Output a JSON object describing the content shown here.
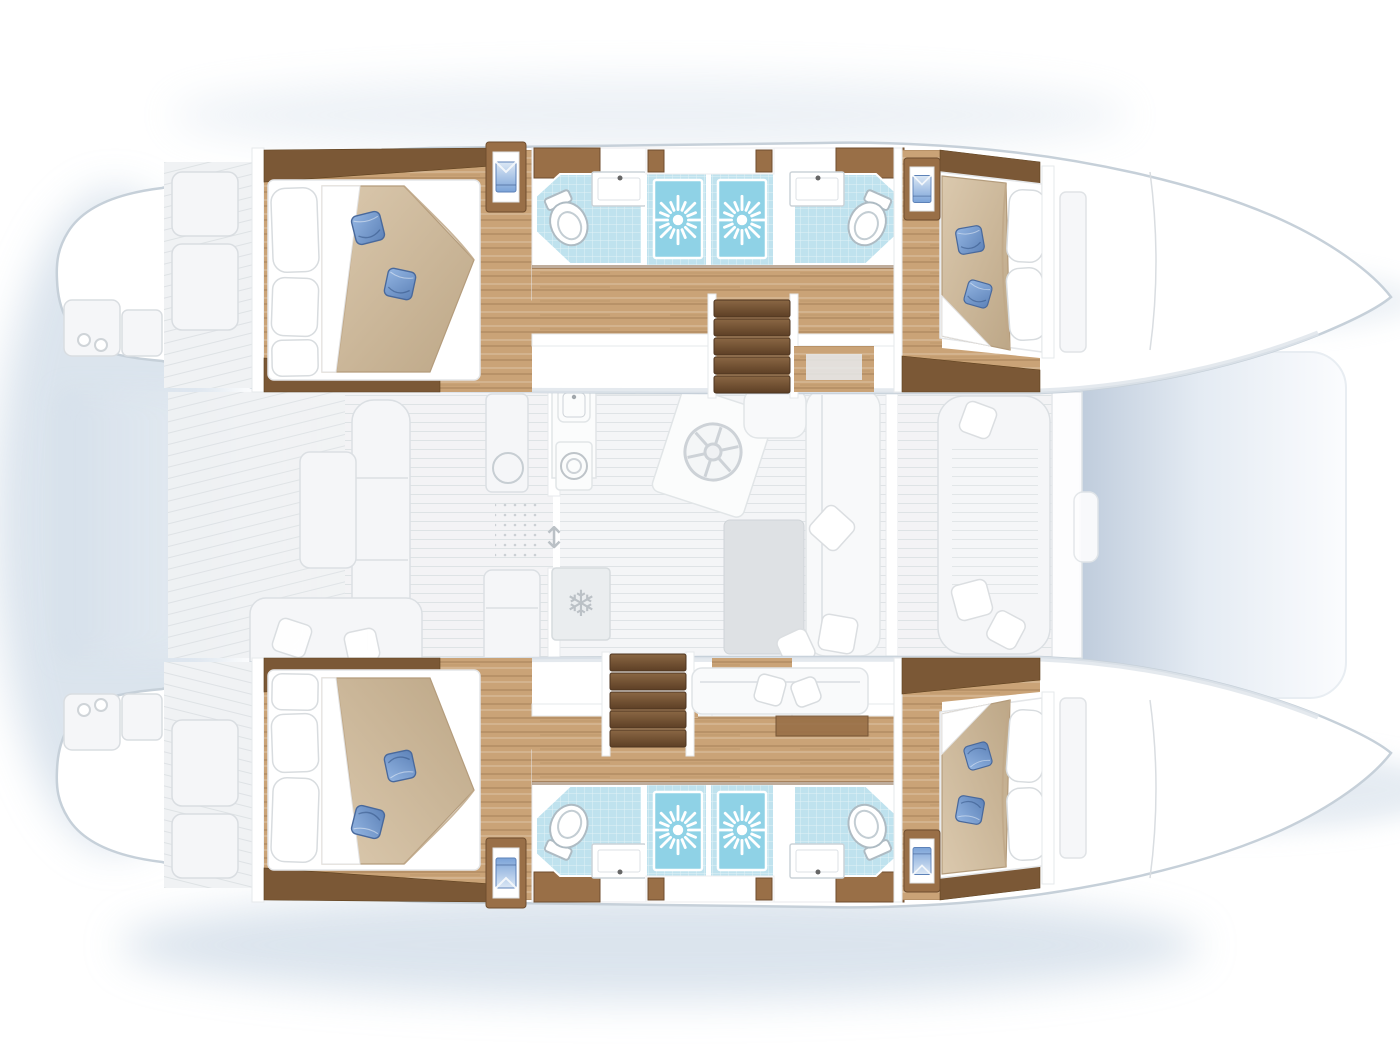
{
  "canvas": {
    "width": 1400,
    "height": 1050
  },
  "colors": {
    "wood_floor": "#caa377",
    "wood_grain": "#a67c50",
    "wood_dark": "#7b5836",
    "wood_cabinet": "#996f47",
    "tile_blue": "#bfe2ee",
    "tile_grid": "#9ccfe0",
    "shower_blue": "#8fd2e6",
    "bed_beige": "#cfbb9e",
    "bed_shadow": "#b49c7c",
    "pillow_blue": "#7ba3d8",
    "pillow_blue_dark": "#49699c",
    "stair_brown": "#6f4e2f",
    "stair_light": "#8a6744",
    "ghost_fill": "#f0f2f4",
    "ghost_line": "#d9dde1",
    "hull_stroke": "#c6d0d9",
    "shadow_blue": "#ccd9e6",
    "table_gray": "#dcdfe2",
    "stove_gray": "#b3b8bc",
    "white": "#ffffff"
  },
  "icons": {
    "snowflake": "❄",
    "door_slide_arrow": "↕"
  },
  "titles": {
    "boat": "Catamaran interior deck plan, bows to the right",
    "port_hull": "Port hull (top)",
    "starboard_hull": "Starboard hull (bottom, mirrored)",
    "aft_cabin": "Aft double cabin with island bed and blue cushions",
    "forward_cabin": "Forward double cabin with island bed and blue cushions",
    "bathroom": "En-suite bathroom with toilet and washbasin",
    "shower": "Separate shower cabin with drain rose",
    "hanging_locker": "Hanging locker with folded shirt",
    "companionway": "Companionway stairs from salon down into hull",
    "cockpit": "Aft cockpit with benches and table (ghosted)",
    "salon": "Salon with galley, table and sofa (ghosted)",
    "galley_stove": "Four burner stove",
    "galley_sinks": "Twin galley sinks",
    "galley_appliance": "Front loading oven",
    "galley_island": "Galley island with deck hatch",
    "refrigerator": "Refrigerator",
    "dining_table": "Salon dining table",
    "sofa": "L-shaped salon sofa with cushions",
    "foredeck": "Forward cockpit lounge seat",
    "trampoline": "Bow trampoline net",
    "transom": "Transom steps and cleats",
    "berth": "Starboard hull sofa berth",
    "chart_desk": "Wood landing beside companionway"
  }
}
